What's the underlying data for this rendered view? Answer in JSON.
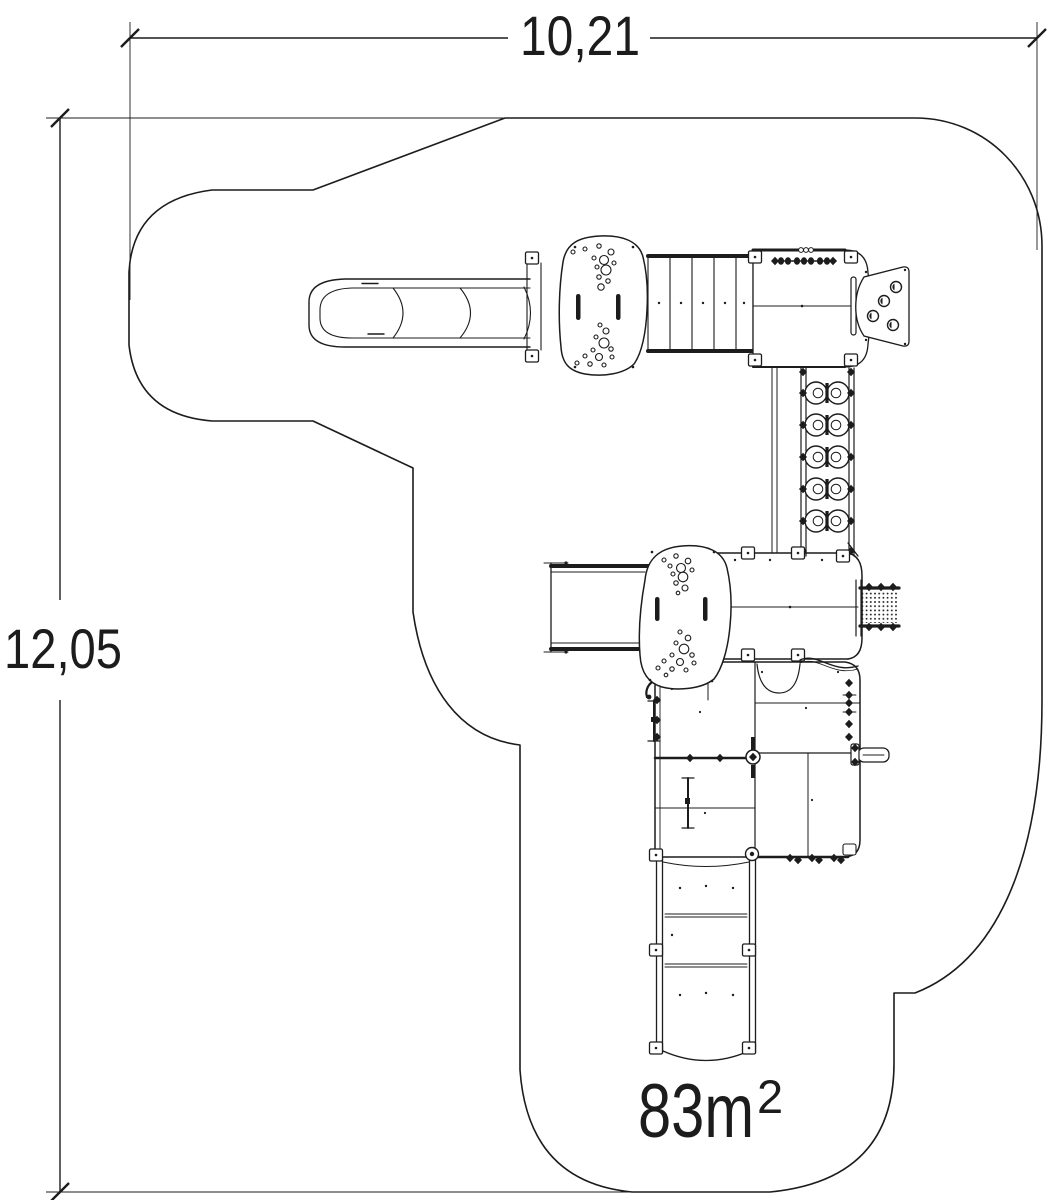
{
  "drawing": {
    "type": "playground-equipment-plan-top-view",
    "background_color": "#ffffff",
    "line_color": "#1c1c1c"
  },
  "dimensions": {
    "width": {
      "label": "10,21"
    },
    "height": {
      "label": "12,05"
    },
    "area": {
      "value": "83m",
      "exponent": "2"
    }
  },
  "components": [
    {
      "id": "safety-zone-outline",
      "label": "safety area boundary"
    },
    {
      "id": "slide",
      "label": "slide"
    },
    {
      "id": "platform-top",
      "label": "upper play platform"
    },
    {
      "id": "bridge",
      "label": "bridge walkway"
    },
    {
      "id": "tower-deck",
      "label": "tower deck"
    },
    {
      "id": "climbing-wall",
      "label": "climbing wall panel"
    },
    {
      "id": "rung-ladder",
      "label": "rung ladder"
    },
    {
      "id": "ramp",
      "label": "access ramp"
    },
    {
      "id": "platform-middle",
      "label": "middle play platform"
    },
    {
      "id": "middle-deck",
      "label": "middle deck"
    },
    {
      "id": "climbing-net",
      "label": "climbing net"
    },
    {
      "id": "play-deck-grid",
      "label": "play deck grid"
    },
    {
      "id": "fire-pole",
      "label": "fire pole"
    },
    {
      "id": "handle-bar",
      "label": "handle bar"
    },
    {
      "id": "walkway",
      "label": "lower walkway"
    }
  ]
}
